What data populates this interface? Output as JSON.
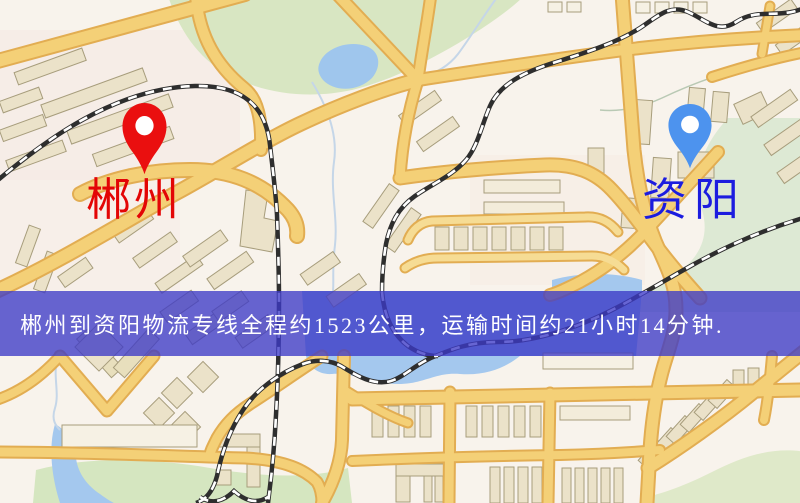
{
  "map": {
    "origin": {
      "label": "郴州",
      "pin_icon": "map-pin",
      "pin_color": "#ea0f0f",
      "label_color": "#e30505"
    },
    "destination": {
      "label": "资阳",
      "pin_icon": "map-pin",
      "pin_color": "#4d93ee",
      "label_color": "#1c1cdf"
    },
    "banner": {
      "text": "郴州到资阳物流专线全程约1523公里，运输时间约21小时14分钟.",
      "background_color": "#3c3ac6",
      "text_color": "#ffffff",
      "route": {
        "origin": "郴州",
        "destination": "资阳",
        "distance_text": "约1523公里",
        "duration_text": "约21小时14分钟"
      }
    },
    "colors": {
      "map_background": "#f8f3ec",
      "road": "#f4d077",
      "road_casing": "#e2ad52",
      "railway_dark": "#2e2e2e",
      "park_green": "#d8e6c2",
      "water_blue": "#a4c8ee",
      "building_tan": "#ebe2c9"
    }
  }
}
